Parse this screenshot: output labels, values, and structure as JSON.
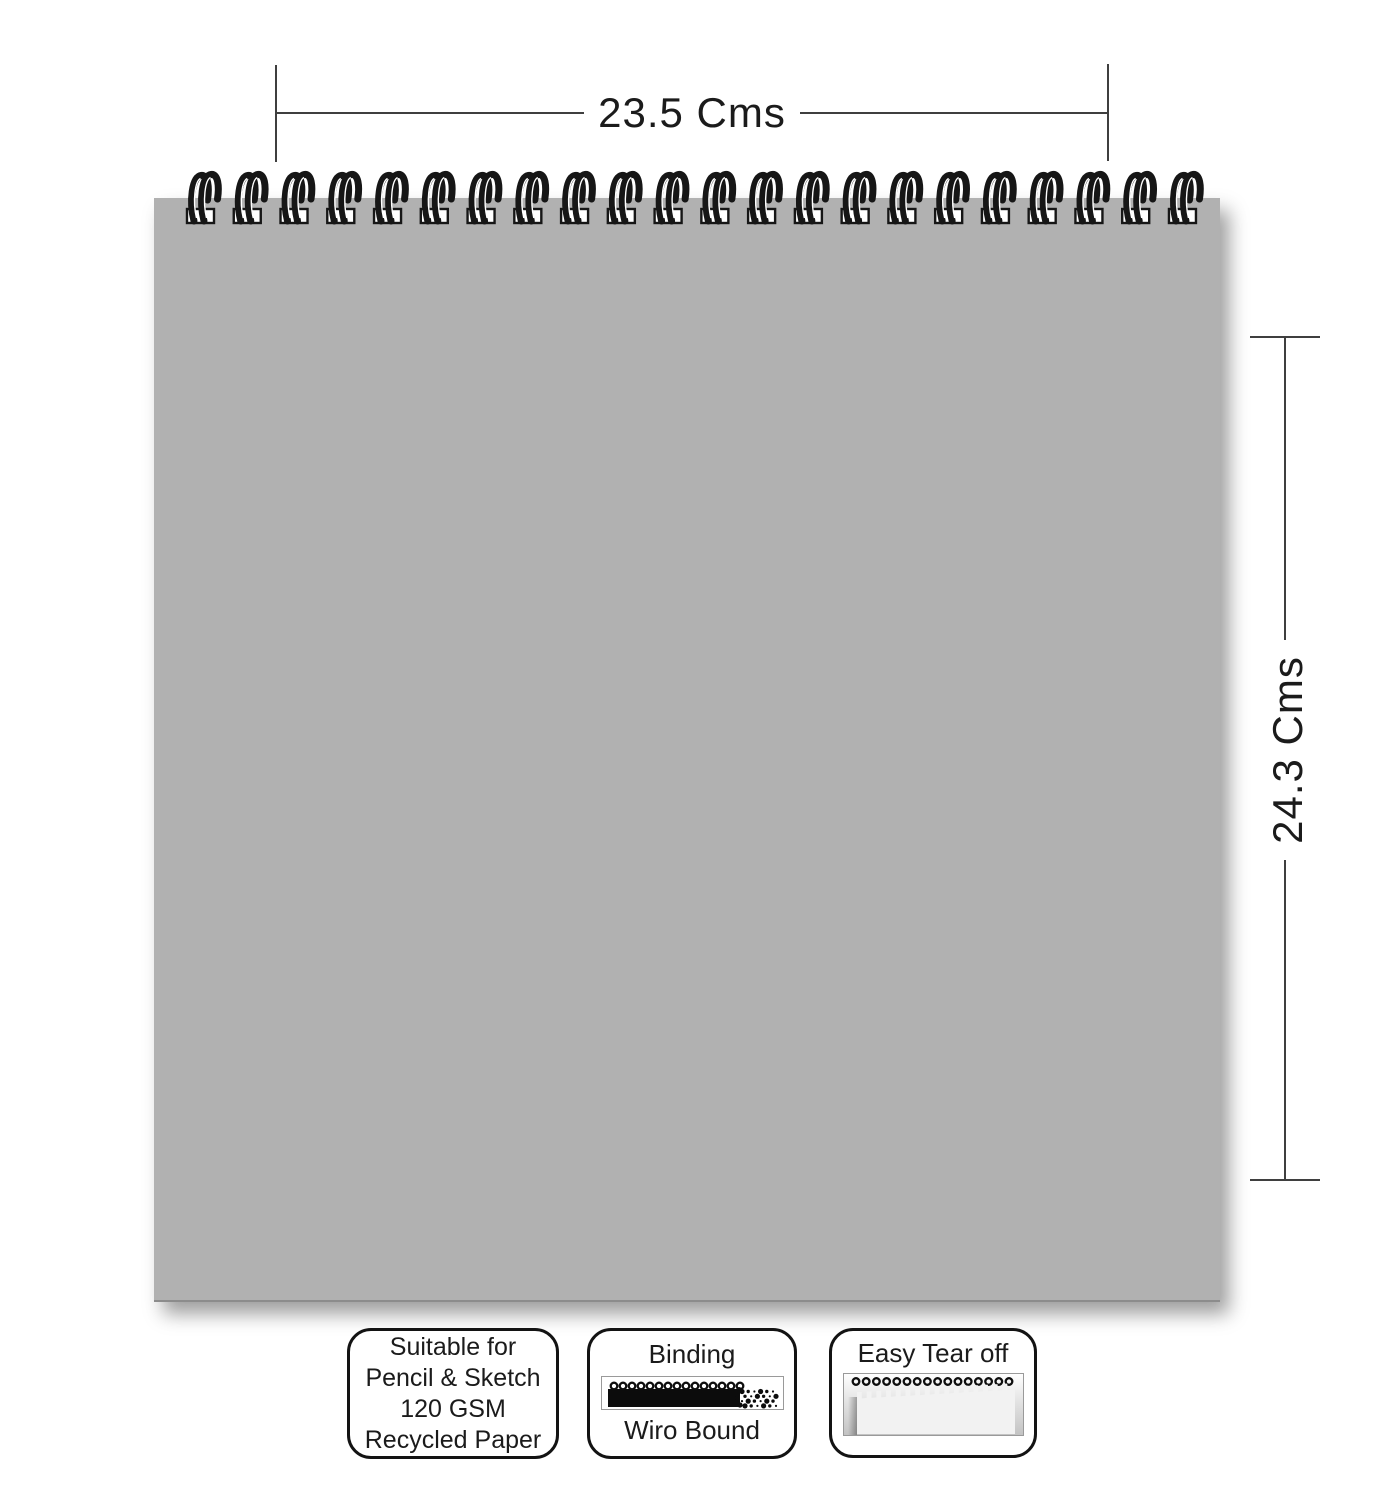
{
  "product": {
    "name": "wiro-bound-sketch-pad"
  },
  "dimensions": {
    "width_label": "23.5 Cms",
    "height_label": "24.3 Cms"
  },
  "features": {
    "paper": {
      "lines": [
        "Suitable for",
        "Pencil & Sketch",
        "120 GSM",
        "Recycled Paper"
      ]
    },
    "binding": {
      "title": "Binding",
      "subtitle": "Wiro Bound",
      "icon": "wiro-binding-strip-icon"
    },
    "tear": {
      "title": "Easy Tear off",
      "icon": "torn-page-icon"
    }
  },
  "colors": {
    "pad_gray": "#b1b1b1",
    "wire_black": "#161616",
    "dimension_line": "#3f3f3f",
    "text": "#1b1b1b"
  },
  "graphics": {
    "coil_count": 22,
    "coil_start": 36,
    "coil_step": 46.76,
    "thumb_binding_loop_count": 15,
    "thumb_tear_loop_count": 16
  }
}
